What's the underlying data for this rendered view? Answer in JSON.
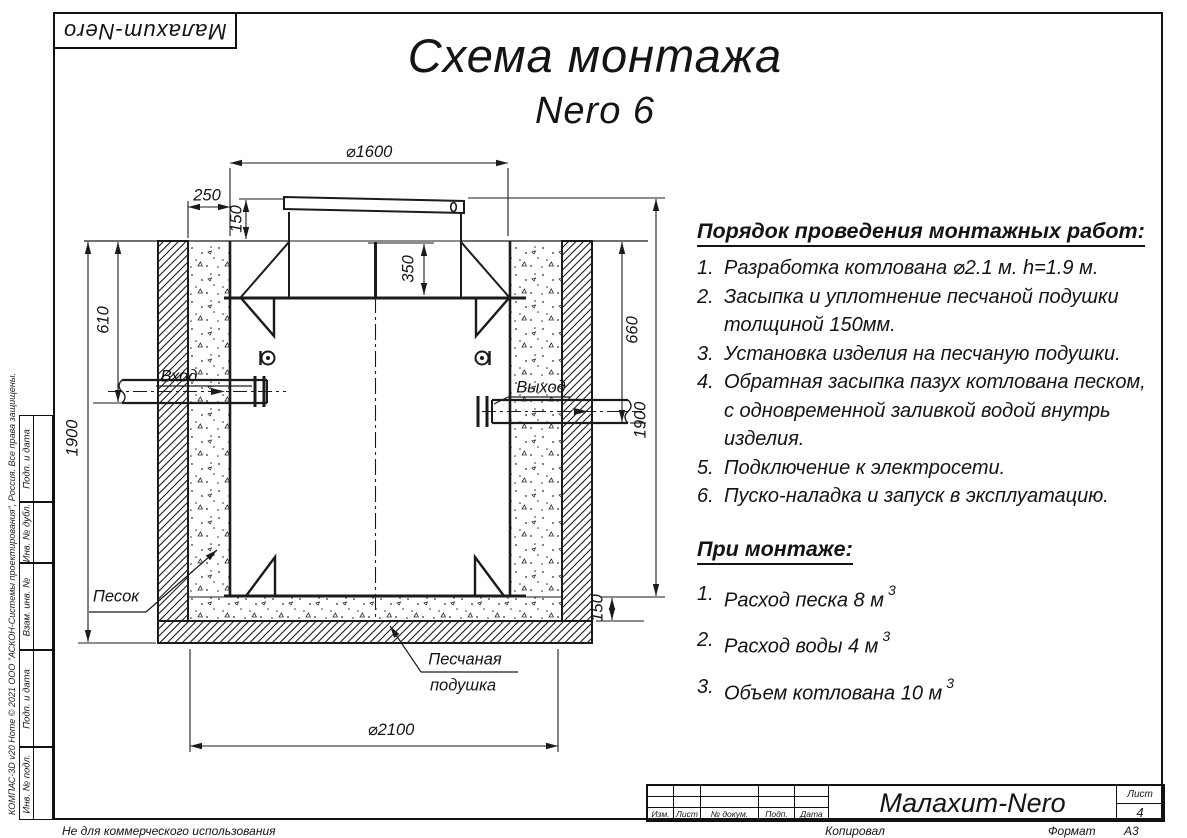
{
  "sheet": {
    "logo": "Малахит-Nero",
    "title_line1": "Схема монтажа",
    "title_line2": "Nero 6",
    "not_for_commercial": "Не для коммерческого использования",
    "copied_label": "Копировал",
    "format_label": "Формат",
    "format_value": "А3"
  },
  "stamp_column": {
    "copyright": "КОМПАС-3D v20 Home © 2021 ООО \"АСКОН-Системы проектирования\", Россия. Все права защищены.",
    "cells": [
      "Подп. и дата",
      "Инв. № дубл.",
      "Взам. инв. №",
      "Подп. и дата",
      "Инв. № подл."
    ]
  },
  "title_block": {
    "company": "Малахит-Nero",
    "col_labels": [
      "Изм.",
      "Лист",
      "№ докум.",
      "Подп.",
      "Дата"
    ],
    "sheet_label": "Лист",
    "sheet_number": "4"
  },
  "drawing": {
    "dims": {
      "tank_diameter": "⌀1600",
      "side_gap": "250",
      "lid_height": "150",
      "neck_depth": "350",
      "inlet_depth": "610",
      "outlet_depth": "660",
      "pit_depth_left": "1900",
      "pit_depth_right": "1900",
      "cushion_thickness": "150",
      "pit_diameter": "⌀2100"
    },
    "labels": {
      "inlet": "Вход",
      "outlet": "Выход",
      "sand": "Песок",
      "cushion_line1": "Песчаная",
      "cushion_line2": "подушка"
    }
  },
  "install": {
    "heading": "Порядок проведения монтажных работ:",
    "steps": [
      {
        "num": "1.",
        "lines": [
          "Разработка котлована ⌀2.1 м. h=1.9 м."
        ]
      },
      {
        "num": "2.",
        "lines": [
          "Засыпка и уплотнение песчаной подушки",
          "толщиной 150мм."
        ]
      },
      {
        "num": "3.",
        "lines": [
          "Установка изделия на песчаную подушки."
        ]
      },
      {
        "num": "4.",
        "lines": [
          "Обратная засыпка пазух котлована песком,",
          "с одновременной заливкой водой внутрь",
          "изделия."
        ]
      },
      {
        "num": "5.",
        "lines": [
          "Подключение к электросети."
        ]
      },
      {
        "num": "6.",
        "lines": [
          "Пуско-наладка и запуск в эксплуатацию."
        ]
      }
    ]
  },
  "montage": {
    "heading": "При монтаже:",
    "items": [
      {
        "num": "1.",
        "text": "Расход песка 8 м",
        "sup": "3"
      },
      {
        "num": "2.",
        "text": "Расход воды 4 м",
        "sup": "3"
      },
      {
        "num": "3.",
        "text": "Объем котлована 10 м",
        "sup": "3"
      }
    ]
  }
}
